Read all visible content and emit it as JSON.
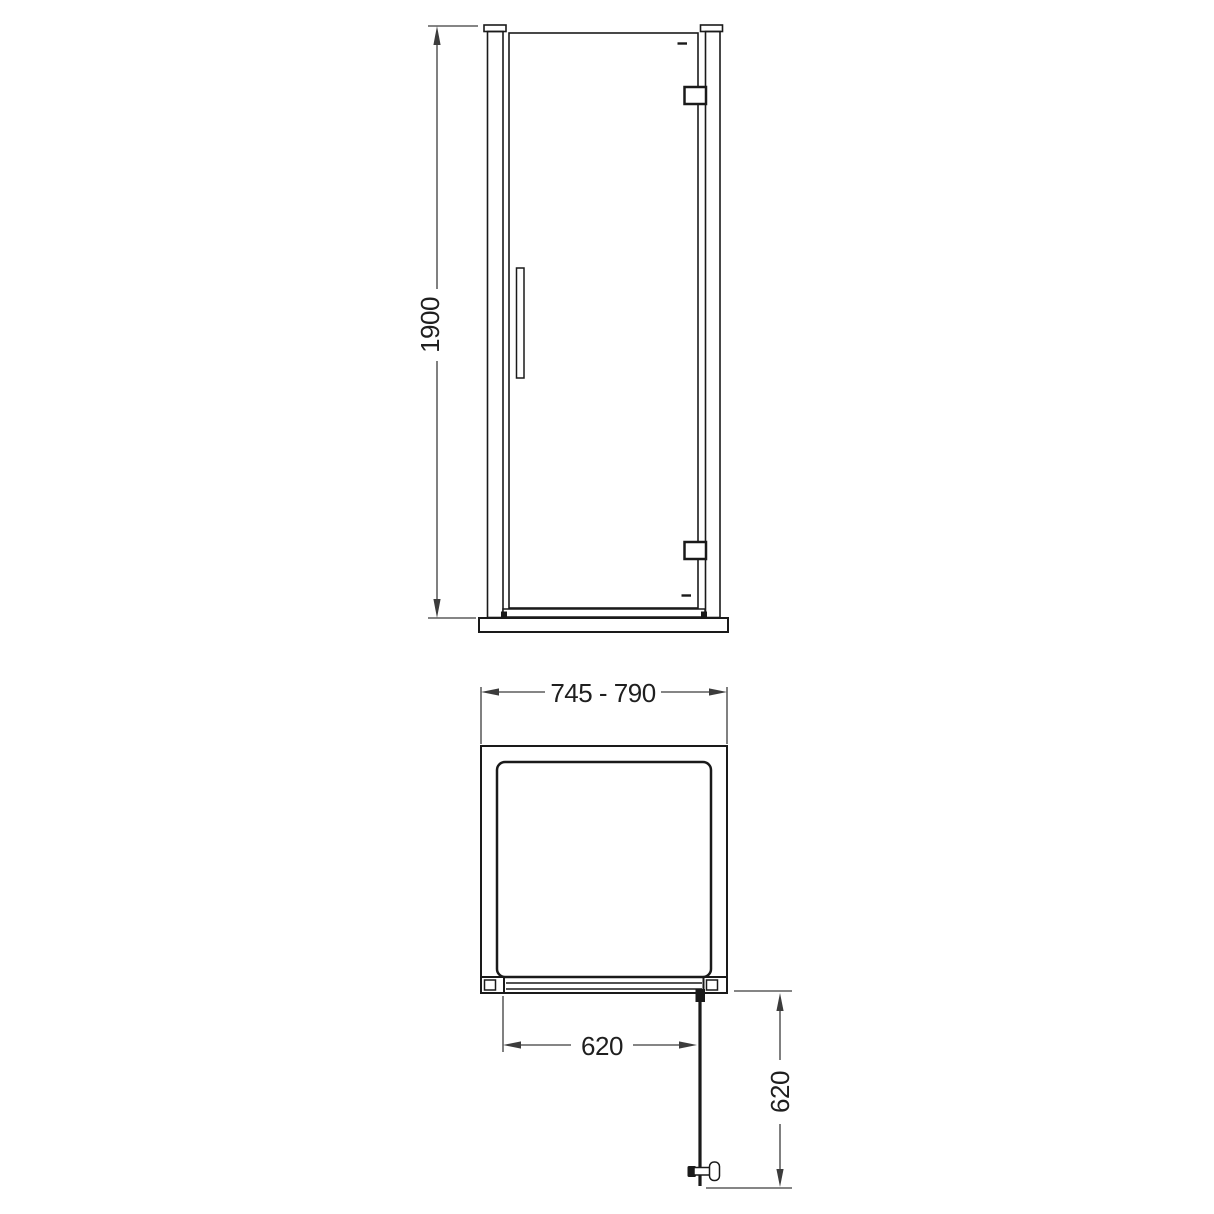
{
  "page": {
    "background": "#ffffff",
    "line_color": "#1a1a1a",
    "dim_line_color": "#3c3c3c",
    "text_color": "#1f1f1f"
  },
  "front_view": {
    "name": "front-elevation",
    "height_dimension": "1900"
  },
  "plan_view": {
    "name": "plan-view",
    "overall_width_dimension": "745 - 790",
    "door_opening_dimension": "620",
    "door_projection_dimension": "620"
  }
}
